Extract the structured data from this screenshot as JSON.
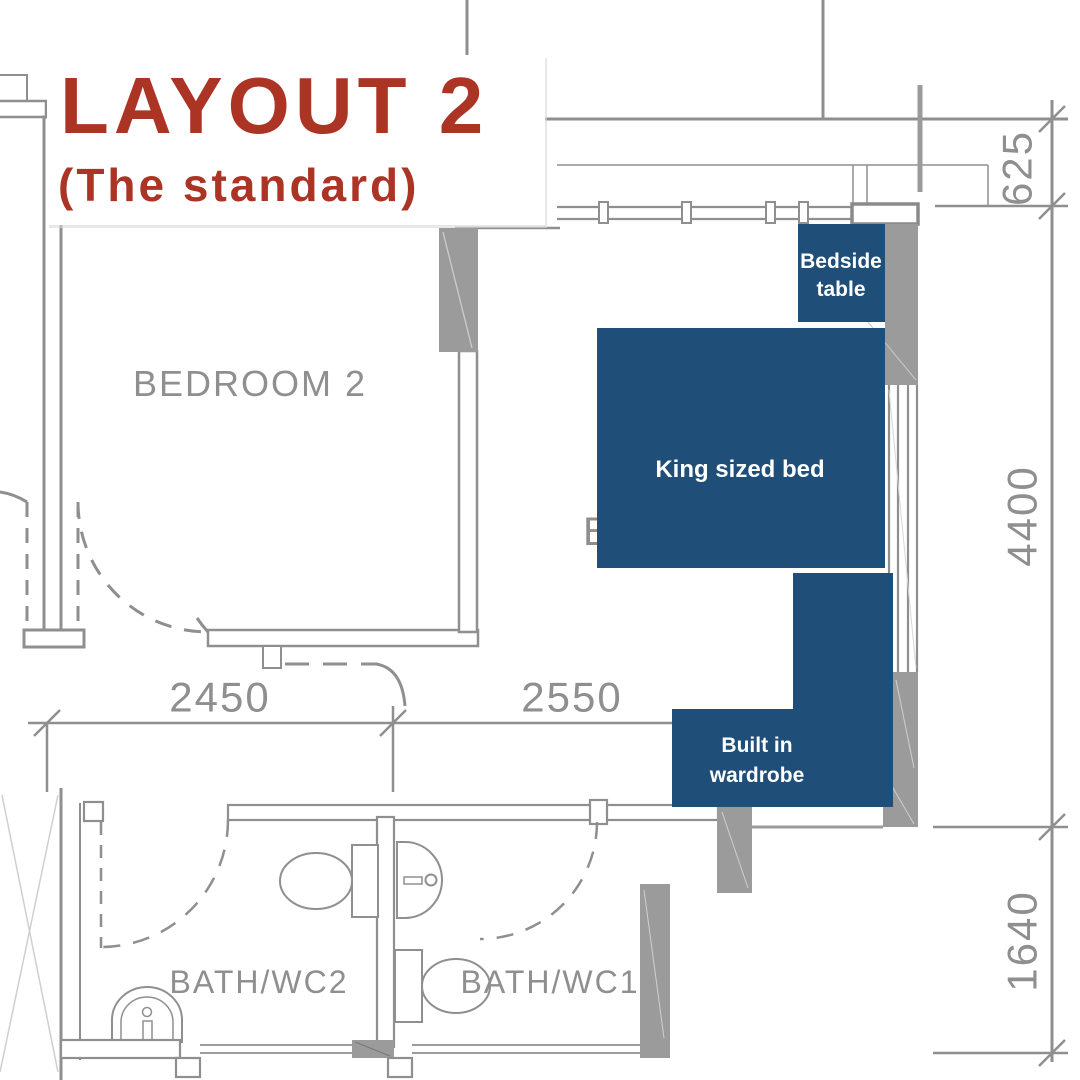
{
  "title": {
    "main": "LAYOUT 2",
    "subtitle": "(The standard)"
  },
  "rooms": {
    "bedroom2": "BEDROOM 2",
    "bath_wc2": "BATH/WC2",
    "bath_wc1": "BATH/WC1",
    "hidden_room_fragment": "B"
  },
  "furniture": {
    "bedside_table": {
      "line1": "Bedside",
      "line2": "table"
    },
    "king_bed": {
      "label": "King sized bed"
    },
    "wardrobe": {
      "line1": "Built in",
      "line2": "wardrobe"
    }
  },
  "dimensions": {
    "bedroom2_width": "2450",
    "bedroom1_width": "2550",
    "balcony_depth": "625",
    "bedroom_depth": "4400",
    "bath_depth": "1640"
  },
  "colors": {
    "accent_red": "#ab3425",
    "furniture_blue": "#1f4e78",
    "wall_gray": "#9b9b9b",
    "line_gray": "#8f8f8f",
    "hairline_gray": "#cfcfcf"
  }
}
